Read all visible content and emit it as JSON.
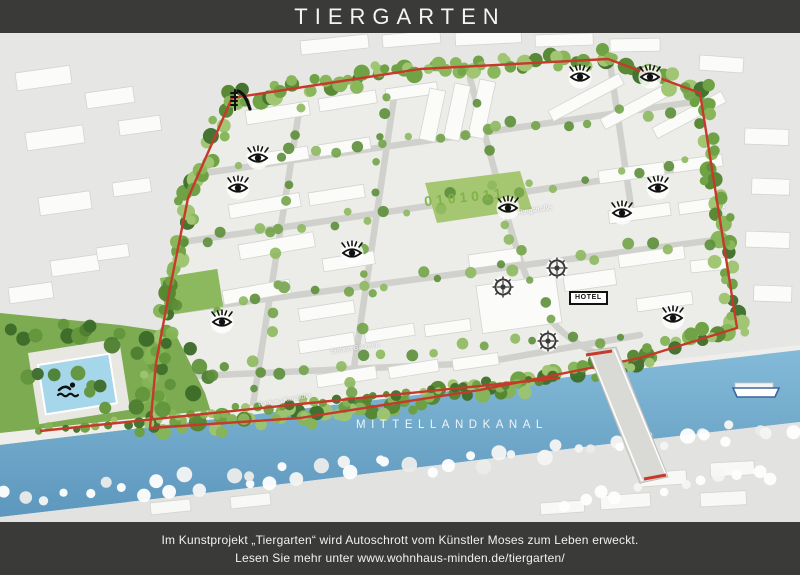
{
  "header": {
    "title": "TIERGARTEN"
  },
  "map": {
    "canal_label": "MITTELLANDKANAL",
    "hotel_label": "HOTEL",
    "hedge_text": "0101011",
    "street_labels": [
      {
        "text": "Ringstraße"
      },
      {
        "text": "Sieben Bäumen"
      },
      {
        "text": "Radweg Kanalufer"
      }
    ],
    "markers": [
      {
        "type": "eye",
        "x": 258,
        "y": 125
      },
      {
        "type": "eye",
        "x": 238,
        "y": 155
      },
      {
        "type": "eye",
        "x": 580,
        "y": 44
      },
      {
        "type": "eye",
        "x": 650,
        "y": 44
      },
      {
        "type": "eye",
        "x": 658,
        "y": 155
      },
      {
        "type": "eye",
        "x": 622,
        "y": 180
      },
      {
        "type": "eye",
        "x": 508,
        "y": 175
      },
      {
        "type": "eye",
        "x": 352,
        "y": 220
      },
      {
        "type": "eye",
        "x": 222,
        "y": 289
      },
      {
        "type": "eye",
        "x": 673,
        "y": 285
      },
      {
        "type": "wheel",
        "x": 557,
        "y": 235
      },
      {
        "type": "wheel",
        "x": 503,
        "y": 254
      },
      {
        "type": "wheel",
        "x": 548,
        "y": 308
      },
      {
        "type": "slide",
        "x": 240,
        "y": 67
      },
      {
        "type": "swimmer",
        "x": 68,
        "y": 357
      }
    ],
    "colors": {
      "bar_bg": "#3a3a38",
      "water": "#6ea9cd",
      "greenbelt": "#679a3d",
      "path_red": "#c6392b"
    }
  },
  "footer": {
    "line1": "Im Kunstprojekt „Tiergarten“ wird Autoschrott vom Künstler Moses zum Leben erweckt.",
    "line2": "Lesen Sie mehr unter www.wohnhaus-minden.de/tiergarten/"
  }
}
